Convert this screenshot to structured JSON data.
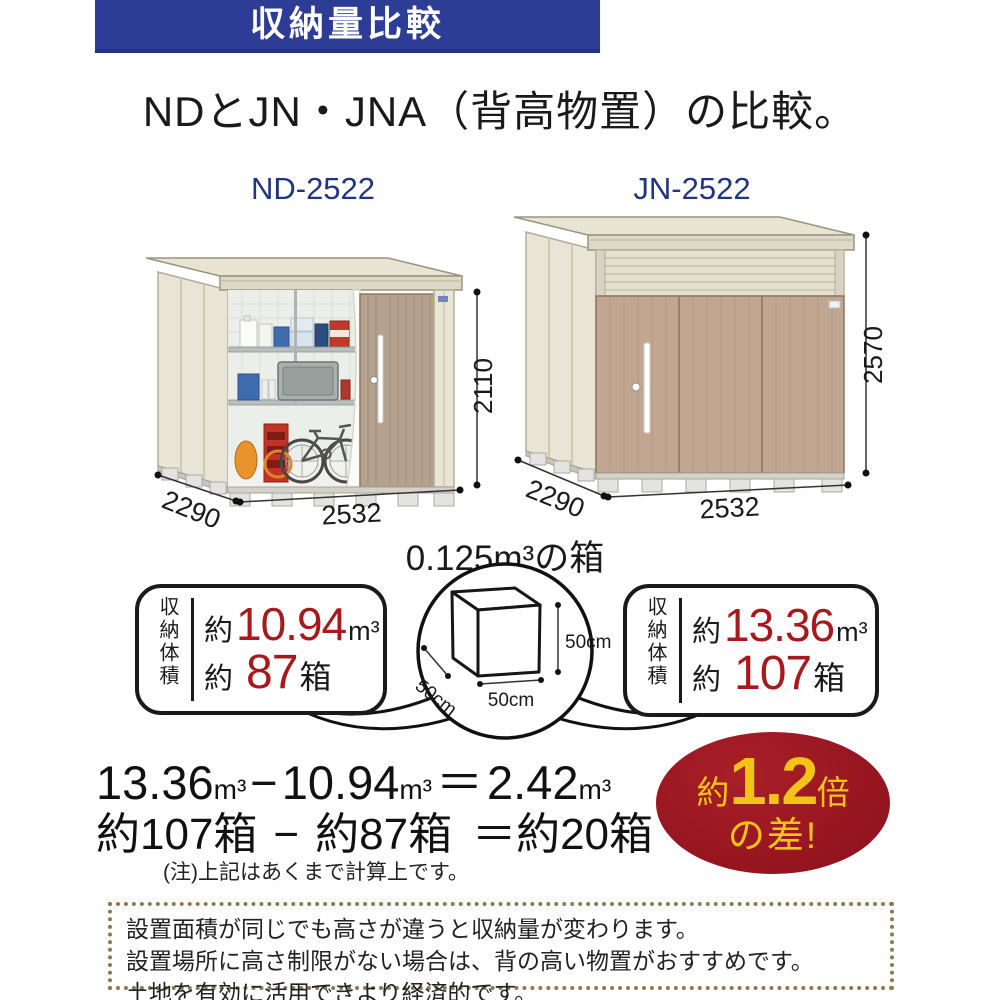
{
  "banner": {
    "title": "収納量比較"
  },
  "heading": "NDとJN・JNA（背高物置）の比較。",
  "sheds": {
    "left": {
      "model": "ND-2522",
      "width": "2532",
      "depth": "2290",
      "height": "2110"
    },
    "right": {
      "model": "JN-2522",
      "width": "2532",
      "depth": "2290",
      "height": "2570"
    }
  },
  "cube": {
    "title": "0.125m³の箱",
    "dim_height": "50cm",
    "dim_width": "50cm",
    "dim_depth": "50cm"
  },
  "volume_left": {
    "label": "収納体積",
    "approx1": "約",
    "value": "10.94",
    "unit": "m³",
    "approx2": "約",
    "boxes": "87",
    "boxes_unit": "箱"
  },
  "volume_right": {
    "label": "収納体積",
    "approx1": "約",
    "value": "13.36",
    "unit": "m³",
    "approx2": "約",
    "boxes": "107",
    "boxes_unit": "箱"
  },
  "calc": {
    "v1": "13.36",
    "u1": "m³",
    "minus": "−",
    "v2": "10.94",
    "u2": "m³",
    "equals": "＝",
    "v3": "2.42",
    "u3": "m³",
    "line2_a": "約107箱",
    "line2_minus": "−",
    "line2_b": "約87箱",
    "line2_equals": "＝",
    "line2_c": "約20箱",
    "note": "(注)上記はあくまで計算上です。"
  },
  "badge": {
    "approx": "約",
    "value": "1.2",
    "times": "倍",
    "line2": "の差!"
  },
  "footer": {
    "line1": "設置面積が同じでも高さが違うと収納量が変わります。",
    "line2": "設置場所に高さ制限がない場合は、背の高い物置がおすすめです。",
    "line3": "土地を有効に活用できより経済的です。"
  },
  "colors": {
    "banner_bg": "#2d3d96",
    "model_text": "#1f3580",
    "accent_red": "#a8191e",
    "badge_bg": "#9c1722",
    "badge_text": "#f2c318",
    "shed_wall": "#e9e5d6",
    "shed_door_tan": "#b3a28d",
    "shed_front_tan": "#c1a791",
    "dotted_border": "#8b7a50"
  }
}
